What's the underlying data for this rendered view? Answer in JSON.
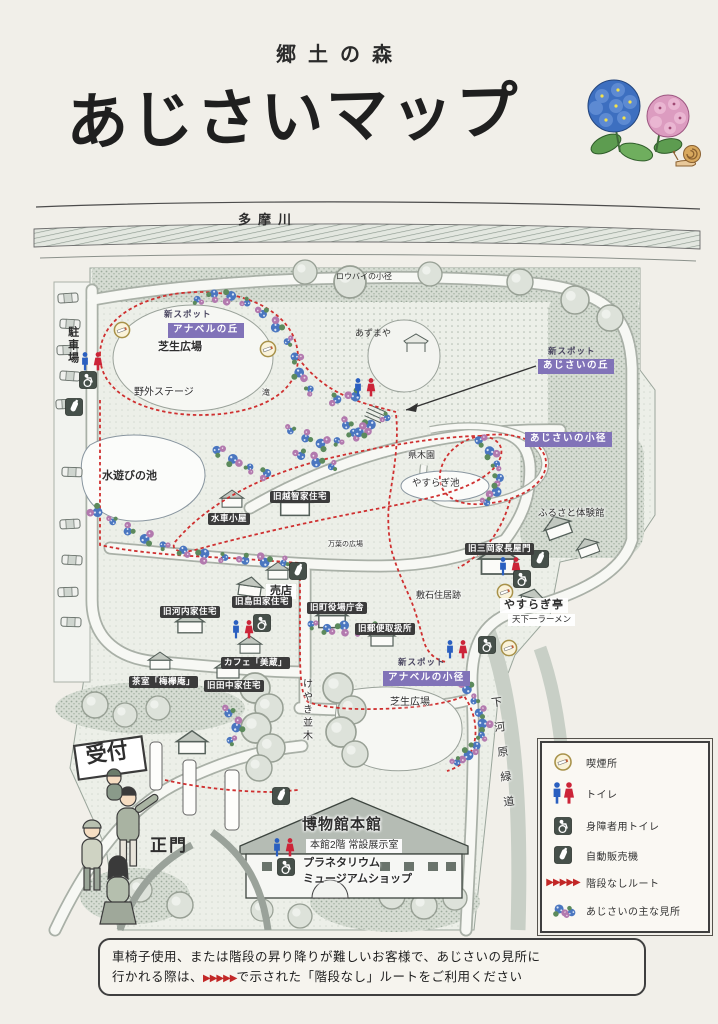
{
  "header": {
    "subtitle": "郷土の森",
    "title": "あじさいマップ"
  },
  "map": {
    "river": "多摩川",
    "labels": {
      "parking": "駐車場",
      "new_spot": "新スポット",
      "annabelle_hill": "アナベルの丘",
      "lawn_plaza": "芝生広場",
      "outdoor_stage": "野外ステージ",
      "robai_path": "ロウバイの小径",
      "azumaya": "あずまや",
      "ajisai_hill": "あじさいの丘",
      "waterfall": "滝",
      "water_play_pond": "水遊びの池",
      "kyu_ochi_house": "旧越智家住宅",
      "watermill_hut": "水車小屋",
      "kenboku_en": "県木園",
      "yasuragi_pond": "やすらぎ池",
      "ajisai_path": "あじさいの小径",
      "furusato_hall": "ふるさと体験館",
      "kyu_mitsuoka_gate": "旧三岡家長屋門",
      "manyo_plaza": "万葉の広場",
      "shop": "売店",
      "kyu_shimada_house": "旧島田家住宅",
      "kyu_kawachi_house": "旧河内家住宅",
      "kyu_town_hall": "旧町役場庁舎",
      "kyu_post_office": "旧郵便取扱所",
      "shikiishi_ruins": "敷石住居跡",
      "yasuragi_tei": "やすらぎ亭",
      "tenka_ichiban": "天下一ラーメン",
      "cafe": "カフェ「美蔵」",
      "tea_room": "茶室「梅欅庵」",
      "kyu_tanaka_house": "旧田中家住宅",
      "annabelle_path": "アナベルの小径",
      "keyaki_namiki": "けやき並木",
      "reception": "受付",
      "main_gate": "正門",
      "museum_main": "博物館本館",
      "museum_2f": "本館2階 常設展示室",
      "planetarium": "プラネタリウム",
      "museum_shop": "ミュージアムショップ",
      "shimogawara_greenway": "下河原緑道"
    }
  },
  "legend": {
    "route_glyph": "▶▶▶▶▶",
    "items": [
      {
        "icon": "smoking-icon",
        "label": "喫煙所"
      },
      {
        "icon": "toilet-icon",
        "label": "トイレ"
      },
      {
        "icon": "accessible-toilet-icon",
        "label": "身障者用トイレ"
      },
      {
        "icon": "vending-machine-icon",
        "label": "自動販売機"
      },
      {
        "icon": "no-stairs-route-icon",
        "label": "階段なしルート"
      },
      {
        "icon": "hydrangea-spot-icon",
        "label": "あじさいの主な見所"
      }
    ]
  },
  "note": {
    "line1": "車椅子使用、または階段の昇り降りが難しいお客様で、あじさいの見所に",
    "line2_pre": "行かれる際は、",
    "arrows": "▶▶▶▶▶",
    "line2_post": "で示された「階段なし」ルートをご利用ください"
  },
  "colors": {
    "route_red": "#cf3030",
    "label_purple": "#8173b8",
    "label_black": "#3b3b3b",
    "hydrangea_blue": "#4a76c0",
    "hydrangea_pink": "#b279ae"
  }
}
